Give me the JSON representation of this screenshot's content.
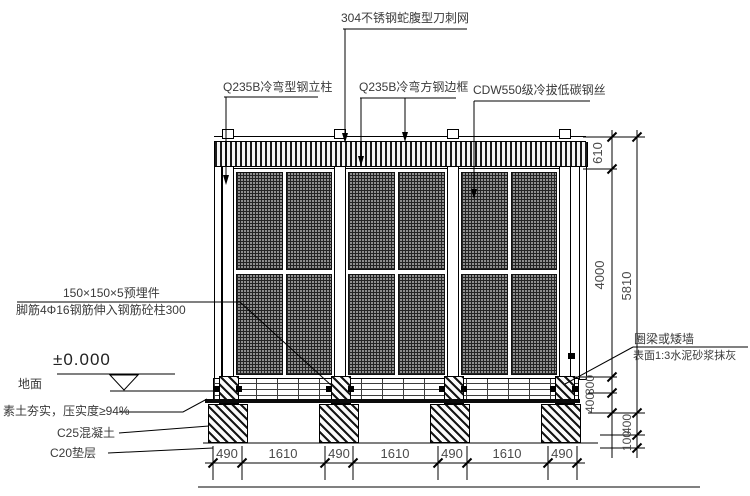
{
  "drawing": {
    "annotations": {
      "razor_mesh": "304不锈钢蛇腹型刀刺网",
      "steel_post": "Q235B冷弯型钢立柱",
      "edge_frame": "Q235B冷弯方钢边框",
      "steel_wire": "CDW550级冷拔低碳钢丝",
      "embed_plate": "150×150×5预埋件",
      "anchor_bar": "脚筋4Φ16钢筋伸入钢筋砼柱300",
      "level_mark": "±0.000",
      "ground": "地面",
      "soil": "素土夯实，压实度≥94%",
      "concrete": "C25混凝土",
      "cushion": "C20垫层",
      "ring_beam": "圈梁或矮墙",
      "plaster": "表面1:3水泥砂浆抹灰"
    },
    "dimensions": {
      "right_inner": [
        "610",
        "4000",
        "300",
        "400"
      ],
      "right_outer": [
        "5810",
        "400",
        "100"
      ],
      "bottom": [
        "490",
        "1610",
        "490",
        "1610",
        "490",
        "1610",
        "490"
      ]
    },
    "colors": {
      "line": "#000000",
      "mesh_fill": "#3f3f3f",
      "background": "#ffffff"
    }
  }
}
